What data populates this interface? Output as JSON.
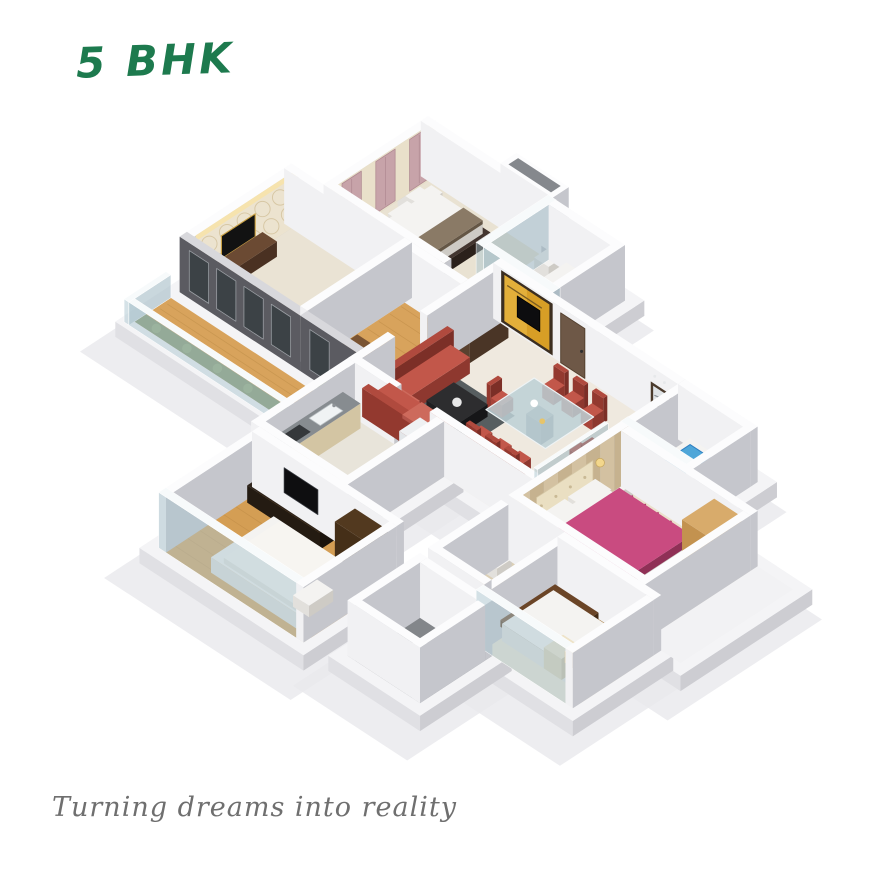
{
  "page": {
    "background": "#ffffff"
  },
  "header": {
    "title": "5 BHK",
    "title_color": "#1d7a4e"
  },
  "footer": {
    "tagline": "Turning dreams into reality",
    "tagline_color": "#6f6f6f"
  },
  "scene": {
    "label": "3D isometric cutaway floor plan render of a 5 BHK apartment",
    "palette": {
      "wall_top": "#fcfcfd",
      "wall_light": "#f1f1f3",
      "wall_shade": "#c5c6cc",
      "dark_exterior": "#5b5b61",
      "dark_exterior_shade": "#47474d",
      "wood_floor": "#d8a35c",
      "bedroom3_wood": "#d49e54",
      "bedroom_floor": "#eae3d4",
      "living_tile": "#efe9df",
      "kitchen_tile": "#e8e4da",
      "master_floor": "#ebe1cc",
      "bath_tile": "#e3e6e6",
      "bath4_tile": "#dbcfb6",
      "utility_gray": "#83868a",
      "gold_feature_wall": "#d79e26",
      "door_brown": "#6e5847",
      "sofa_red": "#bf5547",
      "chair_red": "#c2574a",
      "bed_pink": "#c94b80",
      "bed_brown": "#6b4527",
      "bathtub_blue": "#4fa6d8",
      "garden_green": "#7c8f60",
      "glass_tint": "#acc6d0",
      "wallpaper_cream": "#ece3cf",
      "curtain_pink": "#c7a3a9",
      "headboard_beige": "#d3c1a1",
      "base_white": "#f4f4f6",
      "shadow_gray": "#e8e8ec"
    }
  }
}
